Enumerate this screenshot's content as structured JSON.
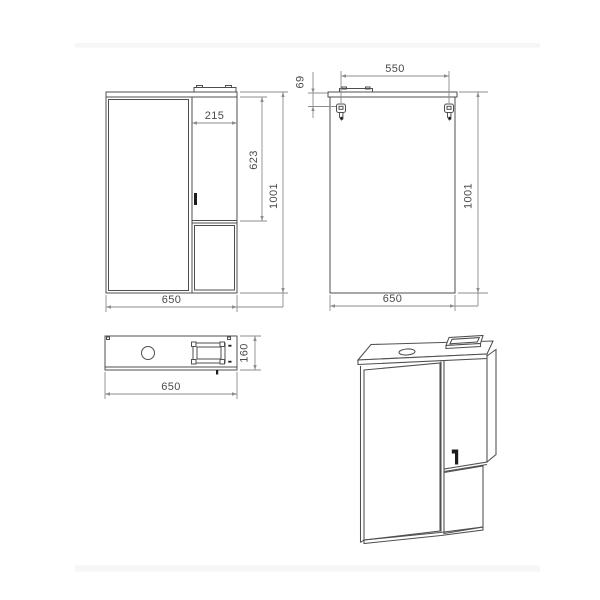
{
  "colors": {
    "background": "#ffffff",
    "line": "#4f4f4f",
    "dim": "#8c8c8c",
    "text": "#4a4a4a",
    "dark": "#1c1c1c",
    "band": "#f6f6f6"
  },
  "views": {
    "front": {
      "dim_door_width": "215",
      "dim_door_height": "623",
      "dim_total_height": "1001",
      "dim_total_width": "650"
    },
    "back": {
      "dim_hanger_spacing": "550",
      "dim_hanger_offset": "69",
      "dim_total_height": "1001",
      "dim_total_width": "650"
    },
    "top": {
      "dim_total_width": "650",
      "dim_depth": "160"
    }
  }
}
